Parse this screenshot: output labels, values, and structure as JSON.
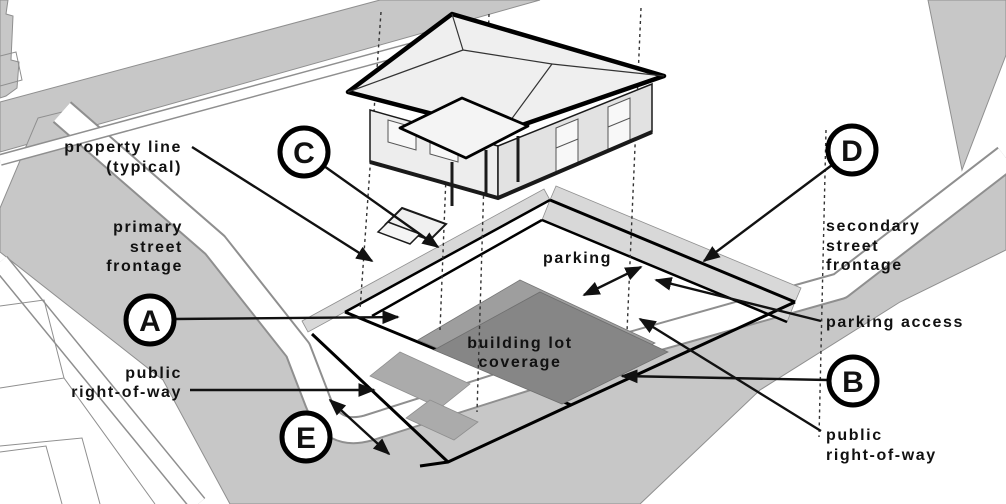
{
  "labels": {
    "property_line": [
      "property line",
      "(typical)"
    ],
    "primary_street_frontage": [
      "primary",
      "street",
      "frontage"
    ],
    "public_right_of_way_left": [
      "public",
      "right-of-way"
    ],
    "secondary_street_frontage": [
      "secondary",
      "street",
      "frontage"
    ],
    "parking_access": "parking access",
    "public_right_of_way_right": [
      "public",
      "right-of-way"
    ],
    "parking": "parking",
    "building_lot_coverage": [
      "building lot",
      "coverage"
    ]
  },
  "markers": {
    "A": "A",
    "B": "B",
    "C": "C",
    "D": "D",
    "E": "E"
  },
  "colors": {
    "street_gray": "#c7c7c7",
    "band_gray": "#d8d8d8",
    "coverage_light": "#9e9e9e",
    "coverage_dark": "#868686",
    "porch_gray": "#ababab",
    "house_fill": "#efefef",
    "ink": "#111111"
  }
}
